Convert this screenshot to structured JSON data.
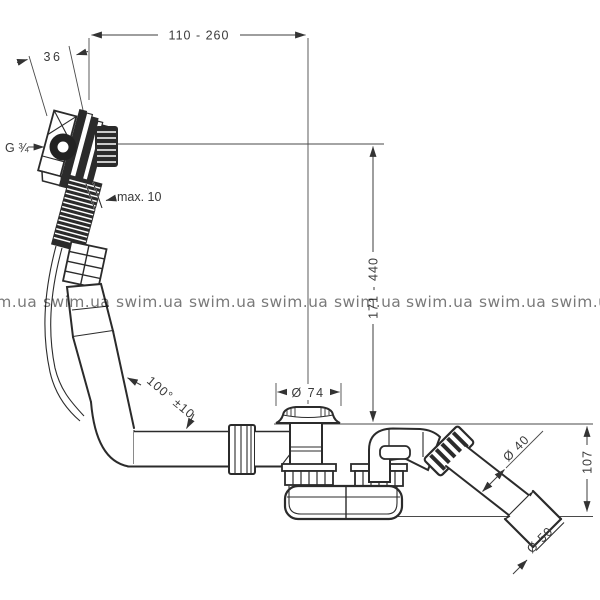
{
  "watermark": {
    "text": "swim.ua"
  },
  "dimensions": {
    "top_width": "110 - 260",
    "plate_offset": "36",
    "thread_size": "G ¾",
    "wall_max": "max. 10",
    "height_range": "171 - 440",
    "flange_diameter": "Ø 74",
    "hose_angle": "100° ±10",
    "pipe_diameter": "Ø 40",
    "outlet_drop": "107",
    "outlet_diameter": "Ø 50"
  },
  "colors": {
    "line": "#2b2b2b",
    "dimension": "#3c3c3c",
    "watermark": "#7a7a7a",
    "background": "#ffffff"
  }
}
